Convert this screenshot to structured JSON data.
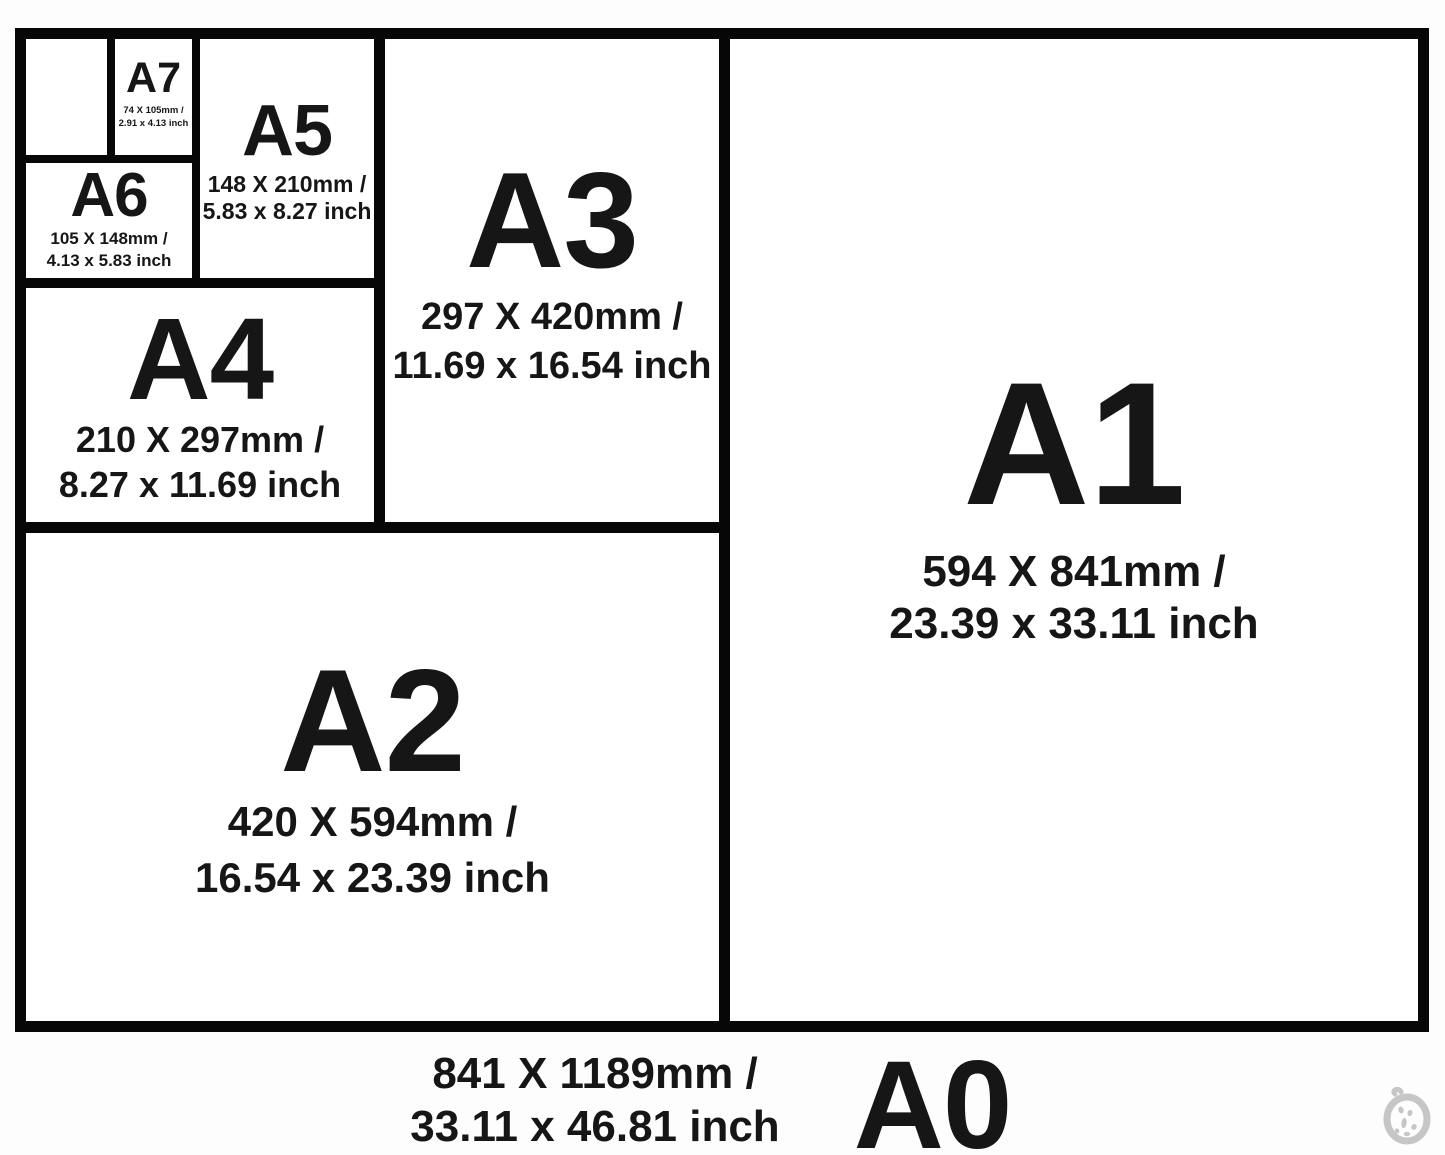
{
  "sizes": [
    {
      "name": "A0",
      "mm": "841 X 1189mm /",
      "inch": "33.11 x 46.81 inch"
    },
    {
      "name": "A1",
      "mm": "594 X 841mm /",
      "inch": "23.39 x 33.11 inch"
    },
    {
      "name": "A2",
      "mm": "420 X 594mm /",
      "inch": "16.54 x 23.39 inch"
    },
    {
      "name": "A3",
      "mm": "297 X 420mm /",
      "inch": "11.69 x 16.54 inch"
    },
    {
      "name": "A4",
      "mm": "210 X 297mm /",
      "inch": "8.27 x 11.69 inch"
    },
    {
      "name": "A5",
      "mm": "148 X 210mm /",
      "inch": "5.83 x 8.27 inch"
    },
    {
      "name": "A6",
      "mm": "105 X 148mm /",
      "inch": "4.13 x 5.83 inch"
    },
    {
      "name": "A7",
      "mm": "74 X 105mm /",
      "inch": "2.91 x 4.13 inch"
    }
  ],
  "colors": {
    "line": "#070707",
    "text": "#161616",
    "background": "#ffffff",
    "watermark": "#c6c6c6"
  }
}
